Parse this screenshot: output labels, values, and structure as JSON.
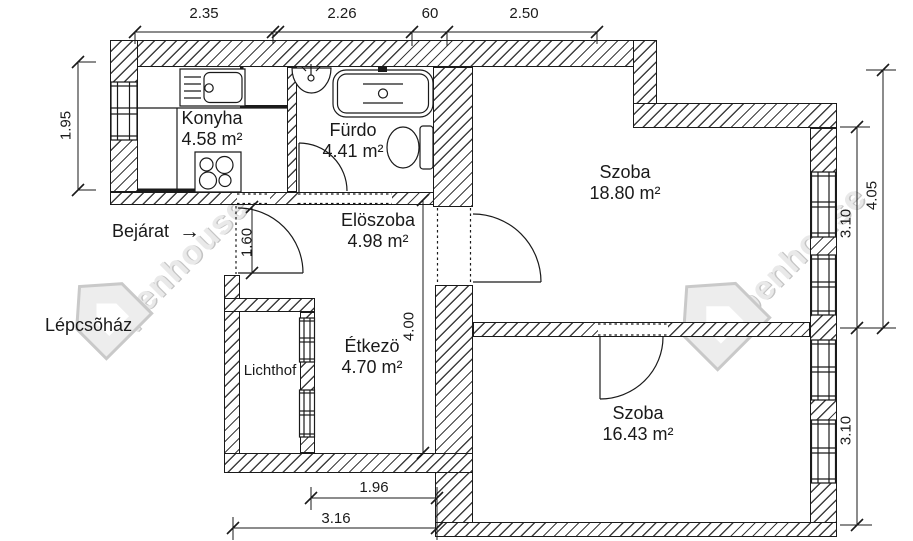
{
  "title": "apartment floor plan",
  "rooms": {
    "konyha": {
      "name": "Konyha",
      "area": "4.58 m²"
    },
    "furdo": {
      "name": "Fürdo",
      "area": "4.41 m²"
    },
    "szoba1": {
      "name": "Szoba",
      "area": "18.80 m²"
    },
    "eloszoba": {
      "name": "Elöszoba",
      "area": "4.98 m²"
    },
    "etkezo": {
      "name": "Étkezö",
      "area": "4.70 m²"
    },
    "szoba2": {
      "name": "Szoba",
      "area": "16.43 m²"
    },
    "lichthof": {
      "name": "Lichthof"
    }
  },
  "annotations": {
    "entrance": "Bejárat",
    "entrance_arrow": "→",
    "stairwell": "Lépcsõház"
  },
  "dimensions": {
    "top": [
      "2.35",
      "2.26",
      "60",
      "2.50"
    ],
    "left": "1.95",
    "right": [
      "4.05",
      "3.10",
      "3.10"
    ],
    "bottom": [
      "1.96",
      "3.16"
    ],
    "inner": [
      "1.60",
      "4.00"
    ]
  },
  "watermark": {
    "text": "openhouse"
  },
  "colors": {
    "line": "#1a1a1a",
    "hatch": "#3e3e3e",
    "watermark": "#e9e9e9"
  }
}
